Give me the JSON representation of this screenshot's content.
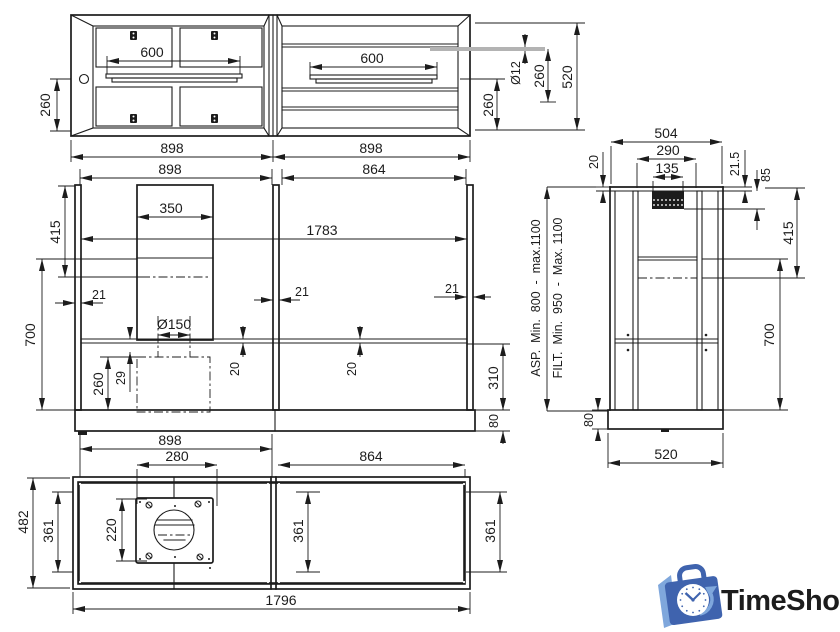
{
  "top_view": {
    "dims": {
      "rod_length_left": "600",
      "rod_length_right": "600",
      "side_260": "260",
      "rod_diameter": "Ø12",
      "upper_260": "260",
      "lower_260": "260",
      "depth": "520",
      "left_width": "898",
      "right_width": "898"
    }
  },
  "front_view": {
    "dims": {
      "left_width": "898",
      "right_width": "864",
      "chimney_width": "350",
      "overall_width": "1783",
      "upper_height": "415",
      "body_height": "700",
      "panel_left": "21",
      "panel_mid": "21",
      "panel_right": "21",
      "duct_diameter": "Ø150",
      "duct_offset": "29",
      "chase_height": "260",
      "shelf_left": "20",
      "shelf_right": "20",
      "lower_height": "310",
      "base_height": "80",
      "bottom_width": "898"
    }
  },
  "side_view": {
    "dims": {
      "depth": "504",
      "inner_width": "290",
      "bracket_width": "135",
      "top_thickness": "20",
      "top_thickness_right": "21.5",
      "bracket_height": "85",
      "upper_height": "415",
      "body_height": "700",
      "base_height": "80",
      "base_depth": "520"
    },
    "labels": {
      "asp": "ASP.  Min.  800  -  max.1100",
      "filt": "FILT.  Min.  950  -  Max. 1100"
    }
  },
  "bottom_view": {
    "dims": {
      "depth": "482",
      "inner_left": "361",
      "plate_height": "220",
      "holes_width": "280",
      "right_width": "864",
      "inner_mid": "361",
      "inner_right": "361",
      "overall_width": "1796"
    }
  },
  "logo": {
    "text": "TimeShop",
    "color": "#5b9bd5"
  }
}
